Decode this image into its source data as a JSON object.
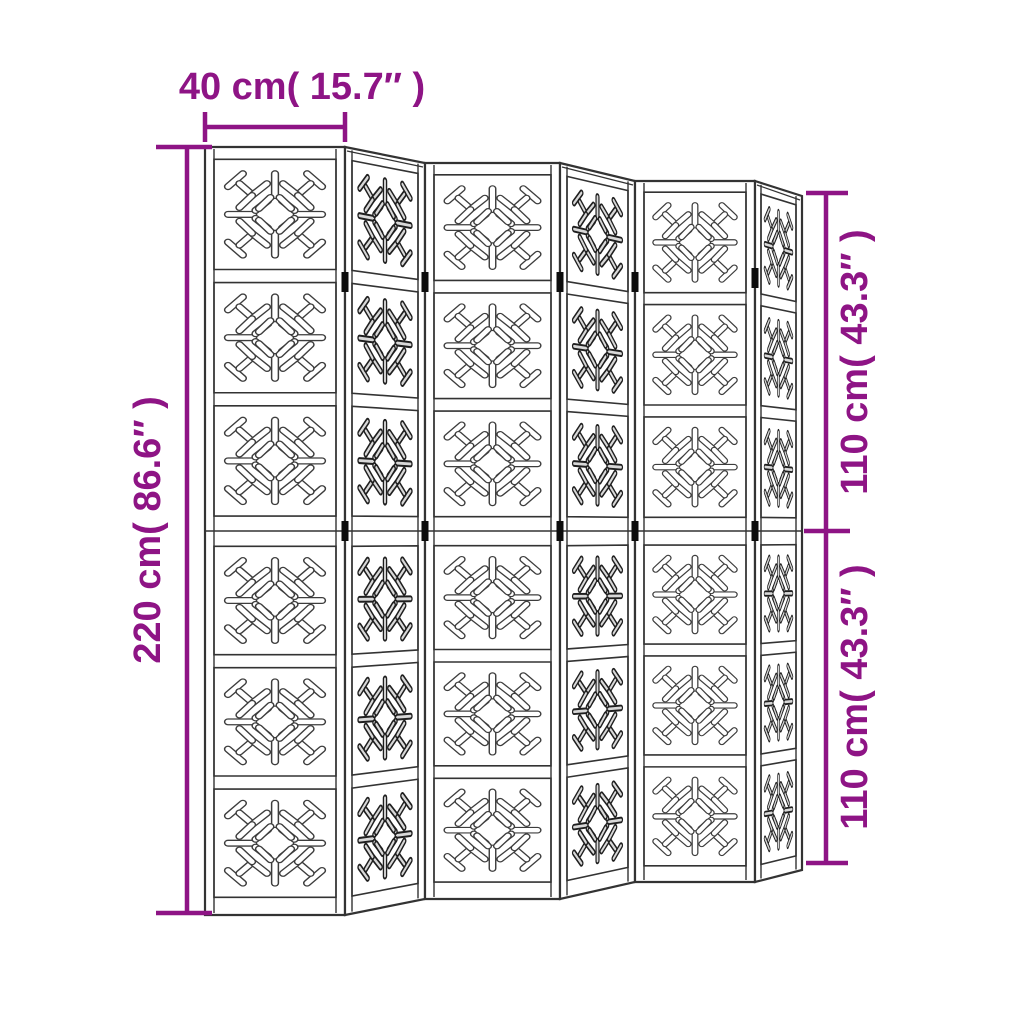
{
  "diagram": {
    "subject": "folding room divider with 6 carved panels",
    "panel_count": 6,
    "squares_per_panel": 6,
    "motif_name": "sunburst-capsule-cutout"
  },
  "colors": {
    "dimension": "#8E1485",
    "line": "#333333",
    "line_dark": "#1f1f1f",
    "hinge": "#0d0d0d",
    "background": "#ffffff",
    "shade_inner": "#d8d8d8",
    "front_inner": "#ffffff"
  },
  "annotations": {
    "top": {
      "label": "40 cm( 15.7″ )",
      "line": [
        205,
        127,
        345,
        127
      ],
      "ticks": [
        [
          205,
          112,
          205,
          142
        ],
        [
          345,
          112,
          345,
          142
        ]
      ],
      "text_pos": [
        302,
        99
      ],
      "rotate": 0
    },
    "left": {
      "label": "220 cm( 86.6″ )",
      "line": [
        187,
        147,
        187,
        913
      ],
      "ticks": [
        [
          156,
          147,
          212,
          147
        ],
        [
          156,
          913,
          212,
          913
        ]
      ],
      "text_pos": [
        160,
        530
      ],
      "rotate": -90
    },
    "right_top": {
      "label": "110 cm( 43.3″ )",
      "line": [
        826,
        193,
        826,
        531
      ],
      "ticks": [
        [
          806,
          193,
          848,
          193
        ],
        [
          804,
          531,
          850,
          531
        ]
      ],
      "text_pos": [
        867,
        362
      ],
      "rotate": -90
    },
    "right_bottom": {
      "label": "110 cm( 43.3″ )",
      "line": [
        826,
        531,
        826,
        863
      ],
      "ticks": [
        [
          806,
          863,
          848,
          863
        ]
      ],
      "text_pos": [
        867,
        697
      ],
      "rotate": -90
    }
  },
  "screen": {
    "mid_y": 531,
    "panels": [
      {
        "name": "panel-1",
        "type": "front",
        "x0": 205,
        "x1": 345,
        "top0": 147,
        "top1": 147,
        "bot0": 915,
        "bot1": 915,
        "stile": 9
      },
      {
        "name": "panel-2",
        "type": "angled",
        "x0": 345,
        "x1": 425,
        "top0": 147,
        "top1": 163,
        "bot0": 915,
        "bot1": 899,
        "stile": 7
      },
      {
        "name": "panel-3",
        "type": "front",
        "x0": 425,
        "x1": 560,
        "top0": 163,
        "top1": 163,
        "bot0": 899,
        "bot1": 899,
        "stile": 9
      },
      {
        "name": "panel-4",
        "type": "angled",
        "x0": 560,
        "x1": 635,
        "top0": 163,
        "top1": 181,
        "bot0": 899,
        "bot1": 882,
        "stile": 7
      },
      {
        "name": "panel-5",
        "type": "front",
        "x0": 635,
        "x1": 755,
        "top0": 181,
        "top1": 181,
        "bot0": 882,
        "bot1": 882,
        "stile": 9
      },
      {
        "name": "panel-6",
        "type": "angled",
        "x0": 755,
        "x1": 802,
        "top0": 181,
        "top1": 196,
        "bot0": 882,
        "bot1": 870,
        "stile": 6
      }
    ],
    "hinges": [
      {
        "x": 345,
        "y": 282
      },
      {
        "x": 345,
        "y": 531
      },
      {
        "x": 425,
        "y": 282
      },
      {
        "x": 425,
        "y": 531
      },
      {
        "x": 560,
        "y": 282
      },
      {
        "x": 560,
        "y": 531
      },
      {
        "x": 635,
        "y": 282
      },
      {
        "x": 635,
        "y": 531
      },
      {
        "x": 755,
        "y": 278
      },
      {
        "x": 755,
        "y": 531
      }
    ],
    "upper_fractions": [
      0,
      0.032,
      0.319,
      0.353,
      0.64,
      0.674,
      0.961,
      1.0
    ],
    "lower_fractions": [
      0,
      0.04,
      0.322,
      0.356,
      0.638,
      0.672,
      0.954,
      1.0
    ],
    "motif_capsules": [
      [
        9,
        22,
        22,
        9
      ],
      [
        78,
        9,
        91,
        22
      ],
      [
        91,
        78,
        78,
        91
      ],
      [
        22,
        91,
        9,
        78
      ],
      [
        19,
        19,
        29,
        29
      ],
      [
        31,
        30,
        43,
        19
      ],
      [
        30,
        31,
        19,
        43
      ],
      [
        81,
        19,
        71,
        29
      ],
      [
        69,
        30,
        57,
        19
      ],
      [
        70,
        31,
        81,
        43
      ],
      [
        81,
        81,
        71,
        71
      ],
      [
        69,
        70,
        57,
        81
      ],
      [
        70,
        69,
        81,
        57
      ],
      [
        19,
        81,
        29,
        71
      ],
      [
        31,
        70,
        43,
        81
      ],
      [
        30,
        69,
        19,
        57
      ],
      [
        50,
        9,
        50,
        31
      ],
      [
        50,
        91,
        50,
        69
      ],
      [
        9,
        50,
        31,
        50
      ],
      [
        91,
        50,
        69,
        50
      ],
      [
        33,
        46,
        44,
        36
      ],
      [
        33,
        54,
        44,
        64
      ],
      [
        67,
        46,
        56,
        36
      ],
      [
        67,
        54,
        56,
        64
      ],
      [
        46,
        33,
        36,
        44
      ],
      [
        54,
        33,
        64,
        44
      ],
      [
        46,
        67,
        36,
        56
      ],
      [
        54,
        67,
        64,
        56
      ]
    ]
  }
}
